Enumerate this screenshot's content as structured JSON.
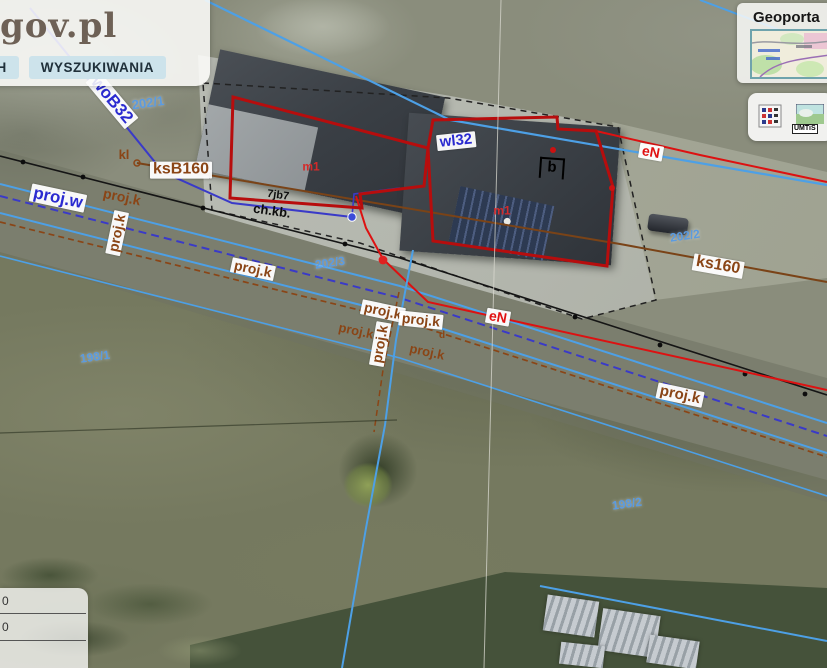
{
  "header": {
    "logo": "gov.pl",
    "tabs": [
      "DANYCH",
      "WYSZUKIWANIA"
    ]
  },
  "minimap": {
    "title": "Geoporta"
  },
  "toolbar": {
    "umtis_label": "UMTiS"
  },
  "coords_panel": {
    "rows": [
      "0",
      "0"
    ]
  },
  "map": {
    "labels": [
      {
        "name": "label-woB32",
        "cls": "navy box",
        "text": "woB32",
        "x": 112,
        "y": 100,
        "rot": 50,
        "fs": 17
      },
      {
        "name": "label-202-1",
        "cls": "num",
        "text": "202/1",
        "x": 148,
        "y": 103,
        "rot": -8,
        "fs": 13
      },
      {
        "name": "label-kl",
        "cls": "brown",
        "text": "kl",
        "x": 124,
        "y": 155,
        "rot": 0,
        "fs": 13
      },
      {
        "name": "label-ksB160",
        "cls": "brown box",
        "text": "ksB160",
        "x": 181,
        "y": 170,
        "rot": 0,
        "fs": 16
      },
      {
        "name": "label-proj-w",
        "cls": "navy box",
        "text": "proj.w",
        "x": 58,
        "y": 198,
        "rot": 12,
        "fs": 17
      },
      {
        "name": "label-proj-k-1",
        "cls": "brown",
        "text": "proj.k",
        "x": 122,
        "y": 197,
        "rot": 12,
        "fs": 14
      },
      {
        "name": "label-proj-k-2",
        "cls": "brown box",
        "text": "proj.k",
        "x": 117,
        "y": 233,
        "rot": -78,
        "fs": 14
      },
      {
        "name": "label-proj-k-3",
        "cls": "brown box",
        "text": "proj.k",
        "x": 253,
        "y": 269,
        "rot": 12,
        "fs": 14
      },
      {
        "name": "label-202-3",
        "cls": "num",
        "text": "202/3",
        "x": 330,
        "y": 263,
        "rot": -8,
        "fs": 12
      },
      {
        "name": "label-7jb7",
        "cls": "black",
        "text": "7jb7",
        "x": 278,
        "y": 196,
        "rot": 8,
        "fs": 11
      },
      {
        "name": "label-ch-kb",
        "cls": "black",
        "text": "ch.kb.",
        "x": 272,
        "y": 211,
        "rot": 8,
        "fs": 13
      },
      {
        "name": "label-wl32",
        "cls": "navy box",
        "text": "wl32",
        "x": 456,
        "y": 141,
        "rot": -6,
        "fs": 15
      },
      {
        "name": "label-b",
        "cls": "black b-marker",
        "text": "b",
        "x": 552,
        "y": 168,
        "rot": 4,
        "fs": 15
      },
      {
        "name": "label-eN-1",
        "cls": "redtx box",
        "text": "eN",
        "x": 651,
        "y": 152,
        "rot": 10,
        "fs": 14
      },
      {
        "name": "label-m1-left",
        "cls": "red-plain",
        "text": "m1",
        "x": 311,
        "y": 167,
        "rot": 0,
        "fs": 12
      },
      {
        "name": "label-m1-right",
        "cls": "red-plain",
        "text": "m1",
        "x": 502,
        "y": 211,
        "rot": 0,
        "fs": 12
      },
      {
        "name": "label-202-2",
        "cls": "num",
        "text": "202/2",
        "x": 685,
        "y": 236,
        "rot": -8,
        "fs": 12
      },
      {
        "name": "label-ks160",
        "cls": "brown box",
        "text": "ks160",
        "x": 718,
        "y": 266,
        "rot": 10,
        "fs": 16
      },
      {
        "name": "label-eN-2",
        "cls": "redtx box",
        "text": "eN",
        "x": 498,
        "y": 317,
        "rot": 10,
        "fs": 14
      },
      {
        "name": "label-proj-k-4",
        "cls": "brown box",
        "text": "proj.k",
        "x": 383,
        "y": 311,
        "rot": 12,
        "fs": 14
      },
      {
        "name": "label-proj-k-5",
        "cls": "brown box",
        "text": "proj.k",
        "x": 421,
        "y": 320,
        "rot": 6,
        "fs": 14
      },
      {
        "name": "label-proj-k-6",
        "cls": "brown box",
        "text": "proj.k",
        "x": 380,
        "y": 344,
        "rot": -80,
        "fs": 14
      },
      {
        "name": "label-proj-k-7",
        "cls": "brown",
        "text": "proj.k",
        "x": 356,
        "y": 331,
        "rot": 12,
        "fs": 13
      },
      {
        "name": "label-proj-k-8",
        "cls": "brown",
        "text": "proj.k",
        "x": 427,
        "y": 352,
        "rot": 12,
        "fs": 13
      },
      {
        "name": "label-d",
        "cls": "brown",
        "text": "d",
        "x": 442,
        "y": 336,
        "rot": 0,
        "fs": 10
      },
      {
        "name": "label-198-1",
        "cls": "num",
        "text": "198/1",
        "x": 95,
        "y": 357,
        "rot": -8,
        "fs": 12
      },
      {
        "name": "label-proj-k-9",
        "cls": "brown box",
        "text": "proj.k",
        "x": 680,
        "y": 395,
        "rot": 12,
        "fs": 15
      },
      {
        "name": "label-198-2",
        "cls": "num",
        "text": "198/2",
        "x": 627,
        "y": 504,
        "rot": -8,
        "fs": 12
      }
    ]
  },
  "colors": {
    "water_line": "#4da0e6",
    "water_proj_line": "#3a3ac8",
    "sewer_line": "#8a4516",
    "power_line": "#dd1111",
    "building_outline": "#b70d0d",
    "parcel_number": "#5b9be0",
    "tab_bg": "#cde3eb"
  }
}
